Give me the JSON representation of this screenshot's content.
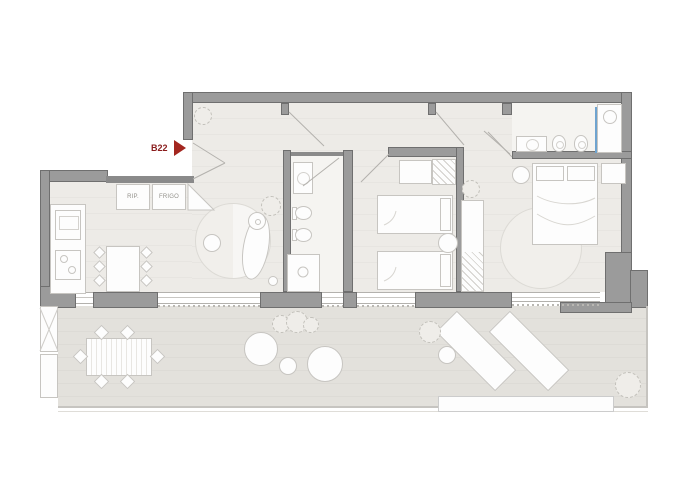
{
  "plan": {
    "unit_label": "B22",
    "labels": {
      "storage_cabinet": "RIP.",
      "fridge_cabinet": "FRIGO"
    },
    "colors": {
      "background": "#ffffff",
      "wall_fill": "#9b9b9b",
      "wall_outline": "#6f6f6f",
      "interior_floor": "#edebe7",
      "bathroom_floor": "#f5f4f1",
      "terrace_floor": "#e2e0db",
      "furniture_fill": "#fdfdfd",
      "furniture_outline": "#c7c5c1",
      "entry_marker_red": "#a3261f",
      "unit_label_red": "#8a1c1c",
      "shower_glass_blue": "#6ea3cf"
    },
    "rooms": [
      "entry-hall",
      "kitchen",
      "living-room",
      "bathroom-1",
      "bedroom-2",
      "master-bedroom",
      "ensuite-bathroom",
      "terrace"
    ],
    "furniture": {
      "kitchen": [
        "counter-with-sink-and-hob",
        "storage-cabinet",
        "fridge-cabinet",
        "corner-cabinet",
        "island-with-six-stools"
      ],
      "living_room": [
        "round-rug",
        "chaise-longue",
        "coffee-table",
        "floor-lamp",
        "plant"
      ],
      "bathroom_1": [
        "vanity",
        "toilet",
        "bidet",
        "shower"
      ],
      "bedroom_2": [
        "desk",
        "wardrobe",
        "single-bed",
        "single-bed",
        "round-side-table"
      ],
      "master_bedroom": [
        "double-bed",
        "round-nightstand",
        "nightstand",
        "wardrobe-column",
        "round-rug",
        "plant"
      ],
      "ensuite_bathroom": [
        "vanity",
        "toilet",
        "bidet",
        "shower-with-glass"
      ],
      "terrace": [
        "dining-table",
        "six-chairs",
        "three-poufs",
        "two-sun-loungers",
        "side-table",
        "plants",
        "planter-box"
      ]
    }
  }
}
